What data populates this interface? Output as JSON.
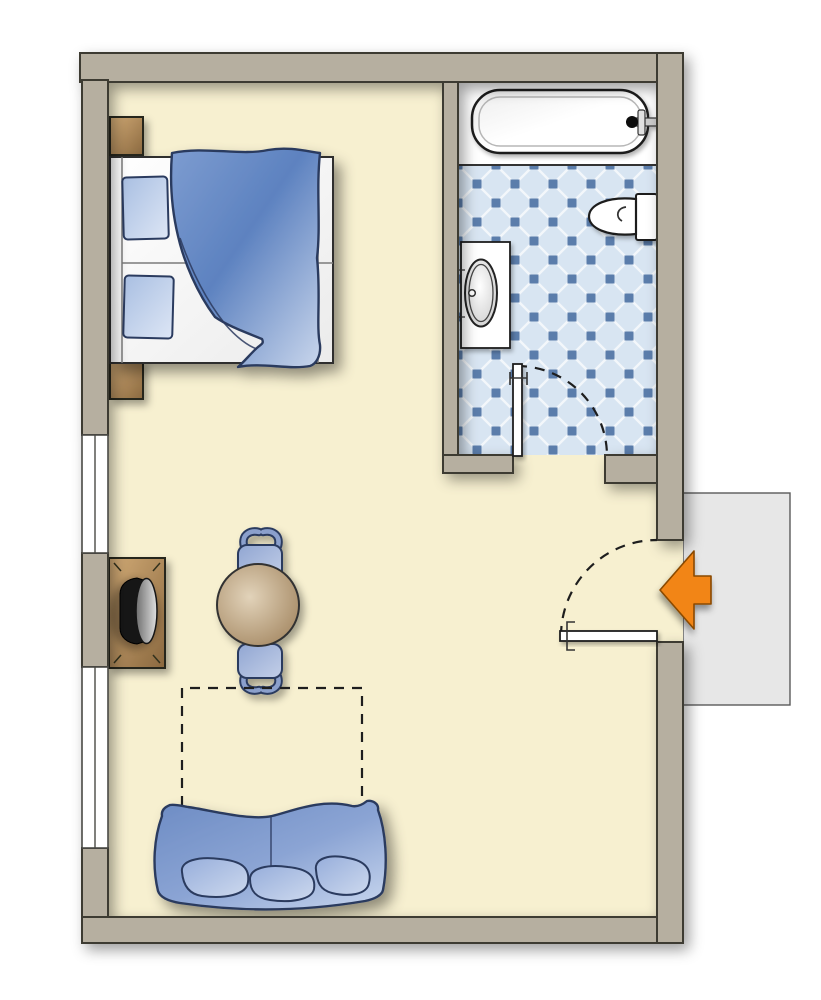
{
  "canvas": {
    "width": 821,
    "height": 1000
  },
  "plan": {
    "name": "Studio hotel room floor plan",
    "rooms": {
      "main_room": {
        "label": "Bedroom / living area"
      },
      "bathroom": {
        "label": "Bathroom with tiled floor"
      },
      "hallway": {
        "label": "Hallway outside entrance"
      }
    },
    "furniture": {
      "bed": {
        "label": "Double bed with blue duvet and two pillows"
      },
      "nightstand_top": {
        "label": "Nightstand"
      },
      "nightstand_bottom": {
        "label": "Nightstand"
      },
      "tv_cabinet": {
        "label": "TV cabinet with television"
      },
      "table": {
        "label": "Round dining table"
      },
      "chair_top": {
        "label": "Chair"
      },
      "chair_bottom": {
        "label": "Chair"
      },
      "sofa": {
        "label": "Sofa with three cushions"
      },
      "foldout_area": {
        "label": "Fold-out bed area (dashed outline)"
      }
    },
    "fixtures": {
      "bathtub": {
        "label": "Bathtub with faucet"
      },
      "toilet": {
        "label": "Toilet"
      },
      "sink": {
        "label": "Washbasin vanity"
      },
      "bathroom_door": {
        "label": "Bathroom door with swing arc"
      },
      "entry_door": {
        "label": "Entrance door with swing arc"
      },
      "entry_arrow": {
        "label": "Entrance direction arrow"
      },
      "window_upper": {
        "label": "Window"
      },
      "window_lower": {
        "label": "Window"
      }
    }
  },
  "colors": {
    "page_bg": "#ffffff",
    "wall_fill": "#b6afa0",
    "wall_outline": "#3e3b33",
    "floor_fill": "#f7f0d0",
    "window_fill": "#ffffff",
    "window_outline": "#4a4a44",
    "hallway_fill": "#e7e7e7",
    "hallway_outline": "#5a5a5a",
    "niche_fill": "#ffffff",
    "tile_bg": "#d8e5f2",
    "tile_line": "#f3f7fb",
    "tile_dot": "#5b7dab",
    "fixture_fill": "#ffffff",
    "fixture_outline": "#1f1f1f",
    "blue_outline": "#2c3a5e",
    "duvet_dark": "#5d82c0",
    "duvet_mid": "#7d9cd0",
    "duvet_light": "#c9d6ec",
    "pillow_light": "#dde6f5",
    "pillow_mid": "#a9bfe2",
    "wood_light": "#d2ab76",
    "wood_dark": "#8a683f",
    "wood_outline": "#26261f",
    "table_light": "#e2d3ba",
    "table_dark": "#a2855f",
    "tv_body": "#121212",
    "screen_light": "#e0e0e0",
    "screen_dark": "#6f6f6f",
    "arrow_fill": "#f28512",
    "arrow_outline": "#8a4a00",
    "dash_color": "#1e1e1e",
    "bedframe_fill": "#fbfbfb",
    "frame_line": "#7a7a7a"
  }
}
